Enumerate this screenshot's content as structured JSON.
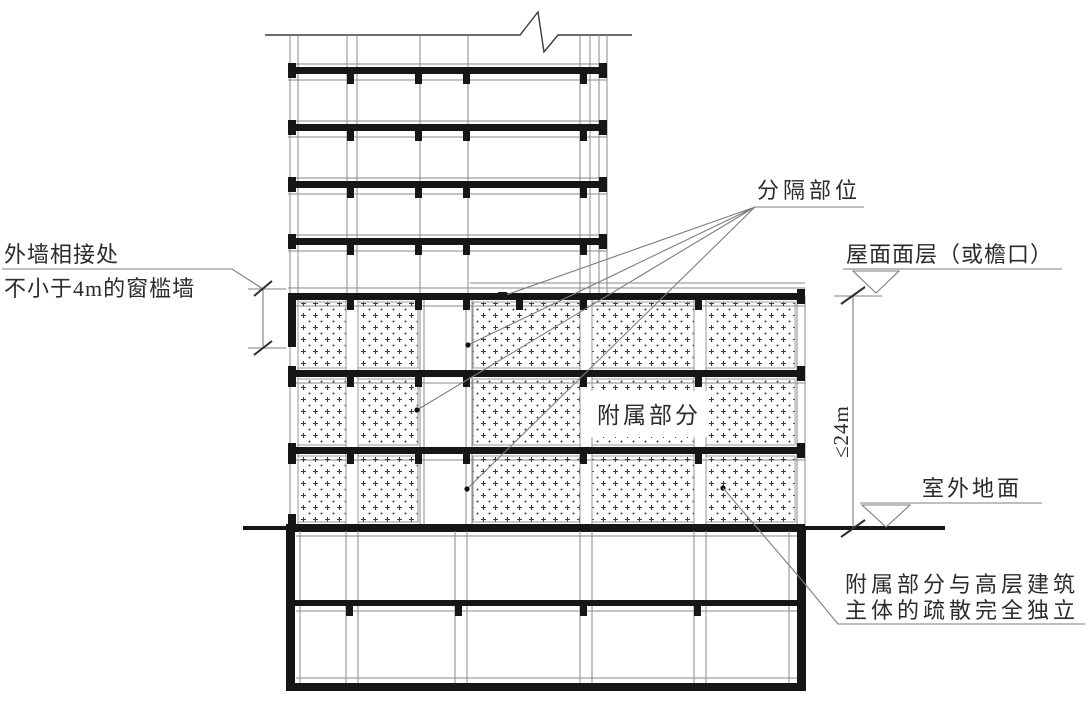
{
  "colors": {
    "background": "#ffffff",
    "line_thick": "#161616",
    "line_thin": "#8a8a8a",
    "hatch_dot": "#3a3a3a",
    "text": "#2b2b2b"
  },
  "labels": {
    "wall_junction_line1": "外墙相接处",
    "wall_junction_line2": "不小于4m的窗槛墙",
    "separation": "分隔部位",
    "roof_finish": "屋面面层（或檐口）",
    "height_limit": "≤24m",
    "outdoor_ground": "室外地面",
    "attached_part": "附属部分",
    "independence_line1": "附属部分与高层建筑",
    "independence_line2": "主体的疏散完全独立"
  }
}
